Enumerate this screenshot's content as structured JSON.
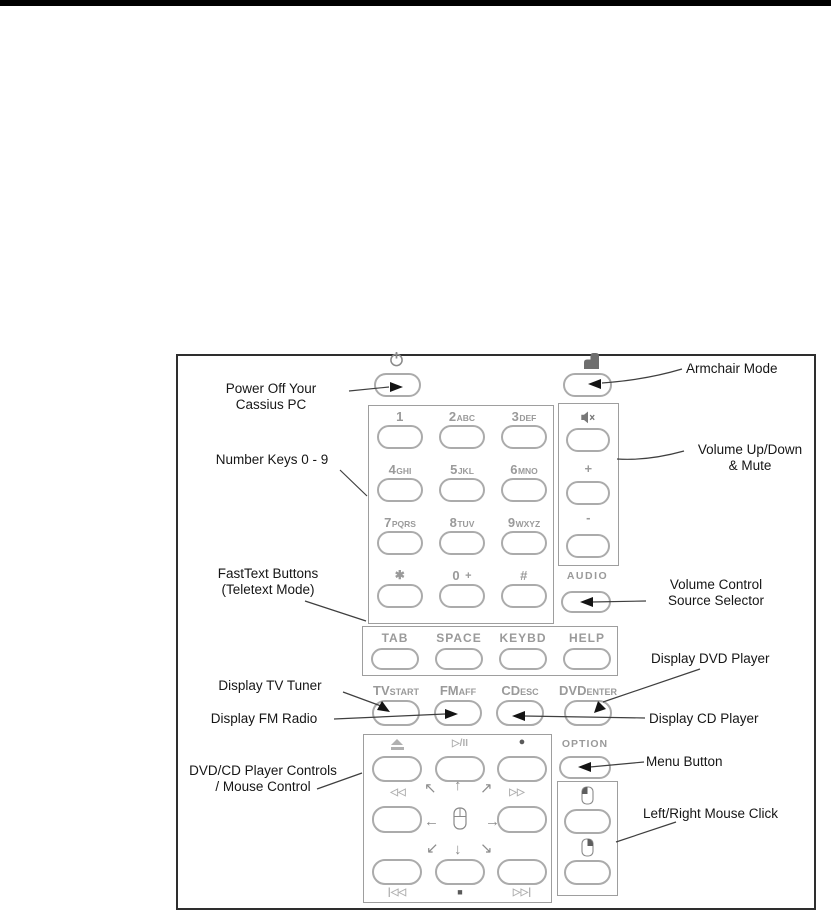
{
  "annotations": {
    "power_off_line1": "Power Off Your",
    "power_off_line2": "Cassius PC",
    "number_keys": "Number Keys 0 - 9",
    "fasttext_line1": "FastText Buttons",
    "fasttext_line2": "(Teletext Mode)",
    "display_tv": "Display TV Tuner",
    "display_fm": "Display FM Radio",
    "dvdcd_line1": "DVD/CD Player Controls",
    "dvdcd_line2": "/ Mouse Control",
    "armchair": "Armchair Mode",
    "volume_line1": "Volume Up/Down",
    "volume_line2": "& Mute",
    "volsrc_line1": "Volume Control",
    "volsrc_line2": "Source Selector",
    "display_dvd": "Display DVD Player",
    "display_cd": "Display CD Player",
    "menu": "Menu Button",
    "mouse_click": "Left/Right Mouse Click"
  },
  "keypad": {
    "keys": [
      {
        "digit": "1",
        "letters": ""
      },
      {
        "digit": "2",
        "letters": "ABC"
      },
      {
        "digit": "3",
        "letters": "DEF"
      },
      {
        "digit": "4",
        "letters": "GHI"
      },
      {
        "digit": "5",
        "letters": "JKL"
      },
      {
        "digit": "6",
        "letters": "MNO"
      },
      {
        "digit": "7",
        "letters": "PQRS"
      },
      {
        "digit": "8",
        "letters": "TUV"
      },
      {
        "digit": "9",
        "letters": "WXYZ"
      },
      {
        "digit": "✱",
        "letters": ""
      },
      {
        "digit": "0",
        "letters": "+"
      },
      {
        "digit": "#",
        "letters": ""
      }
    ]
  },
  "volume": {
    "plus": "+",
    "minus": "-",
    "audio": "AUDIO"
  },
  "function_row": {
    "keys": [
      "TAB",
      "SPACE",
      "KEYBD",
      "HELP"
    ]
  },
  "media_row": {
    "keys": [
      {
        "main": "TV",
        "sub": "START"
      },
      {
        "main": "FM",
        "sub": "AFF"
      },
      {
        "main": "CD",
        "sub": "ESC"
      },
      {
        "main": "DVD",
        "sub": "ENTER"
      }
    ]
  },
  "transport": {
    "play_pause": "▷/II",
    "record": "●",
    "rewind": "◁◁",
    "ffwd": "▷▷",
    "prev": "|◁◁",
    "stop": "■",
    "next": "▷▷|",
    "option": "OPTION",
    "arrows": {
      "nw": "↖",
      "n": "↑",
      "ne": "↗",
      "w": "←",
      "e": "→",
      "sw": "↙",
      "s": "↓",
      "se": "↘"
    }
  },
  "icons": {
    "power": "power-icon",
    "armchair": "armchair-icon",
    "mute": "mute-speaker-icon",
    "eject": "eject-icon",
    "mouse": "mouse-icon",
    "mouse_left": "left-click-mouse-icon",
    "mouse_right": "right-click-mouse-icon"
  },
  "colors": {
    "top_bar": "#000000",
    "outer_border": "#2e2e2e",
    "inner_border": "#9e9e9e",
    "button_border": "#ababab",
    "key_label": "#9a9a9a",
    "annotation_text": "#161616",
    "leader_line": "#3f3f3f",
    "arrowhead": "#141414"
  }
}
